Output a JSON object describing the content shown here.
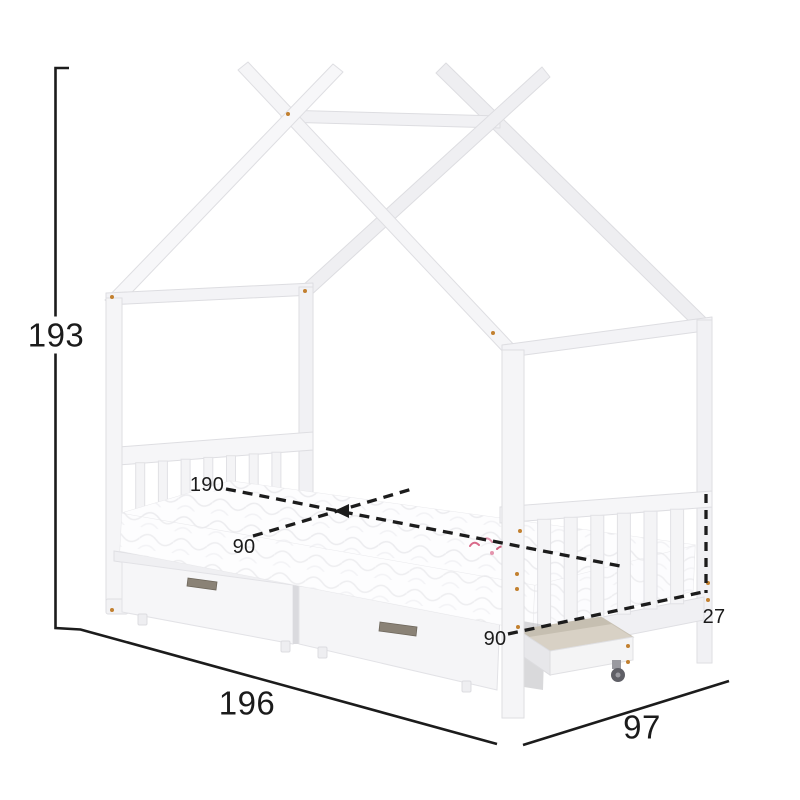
{
  "diagram": {
    "dims": {
      "height": "193",
      "length": "196",
      "width": "97",
      "mattress_length": "190",
      "mattress_width": "90",
      "base_width": "90",
      "rail_height": "27"
    },
    "colors": {
      "dimension_line": "#1c1c1c",
      "screw_dot": "#c2802f",
      "frame_white": "#f4f4f6",
      "frame_shade": "#ededf0",
      "drawer_interior": "#d8d1c5",
      "handle": "#8a8276"
    }
  }
}
